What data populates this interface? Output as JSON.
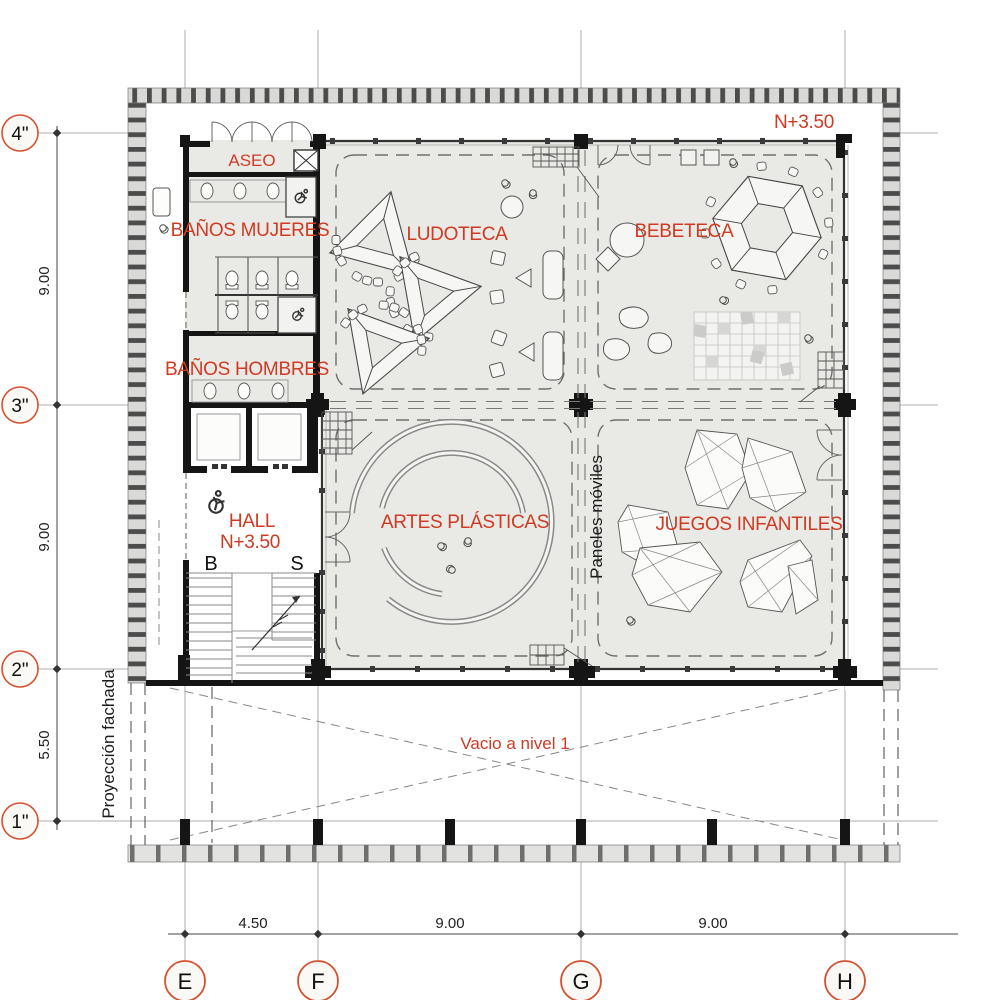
{
  "plan": {
    "level_note": "N+3.50",
    "rooms": {
      "aseo": "ASEO",
      "banos_mujeres": "BAÑOS MUJERES",
      "banos_hombres": "BAÑOS HOMBRES",
      "hall_name": "HALL",
      "hall_level": "N+3.50",
      "ludoteca": "LUDOTECA",
      "bebeteca": "BEBETECA",
      "artes_plasticas": "ARTES PLÁSTICAS",
      "juegos_infantiles": "JUEGOS INFANTILES"
    },
    "annotations": {
      "paneles_moviles": "Paneles móviles",
      "vacio_nivel": "Vacio a nivel 1",
      "proyeccion_fachada": "Proyección fachada",
      "stair_down": "B",
      "stair_up": "S"
    },
    "grid_axes": {
      "rows": [
        {
          "label": "4\""
        },
        {
          "label": "3\""
        },
        {
          "label": "2\""
        },
        {
          "label": "1\""
        }
      ],
      "cols": [
        {
          "label": "E"
        },
        {
          "label": "F"
        },
        {
          "label": "G"
        },
        {
          "label": "H"
        }
      ]
    },
    "dimensions": {
      "left": [
        "9.00",
        "9.00",
        "5.50"
      ],
      "bottom": [
        "4.50",
        "9.00",
        "9.00"
      ]
    },
    "icons": {
      "wheelchair": "accessible-wc",
      "shaft": "shaft-x",
      "stair_arrow": "direction-arrow"
    },
    "colors": {
      "accent_red": "#d03a22",
      "bubble_stroke": "#d4512f",
      "wall": "#151515",
      "floor": "#e9e9e6",
      "hatch_dark": "#4f4f4f",
      "hatch_light": "#d9d9d7"
    }
  }
}
